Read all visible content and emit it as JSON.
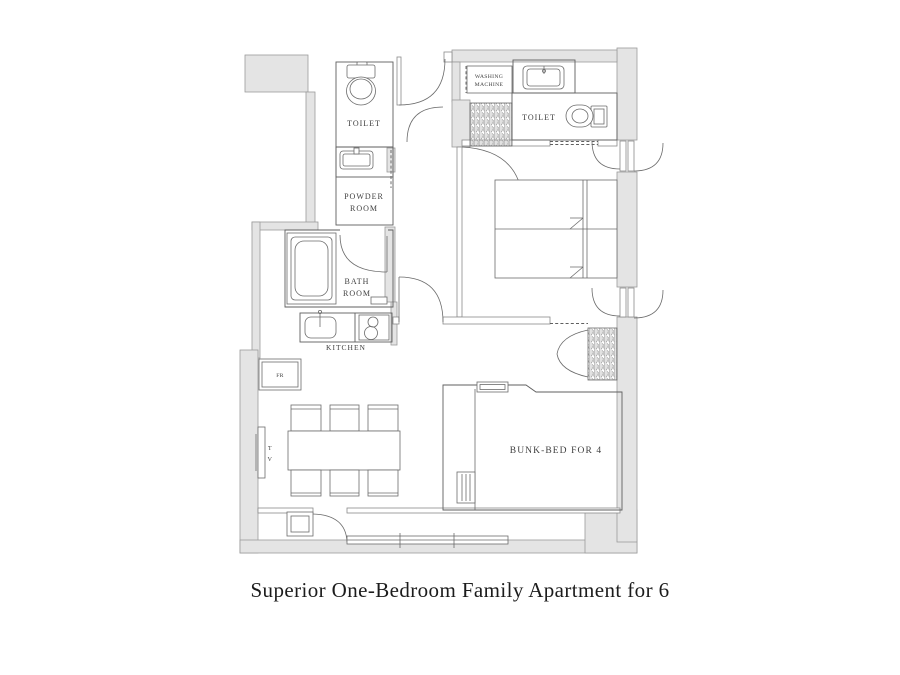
{
  "caption": "Superior One-Bedroom Family Apartment for 6",
  "labels": {
    "toilet_top_left": "TOILET",
    "powder_line1": "POWDER",
    "powder_line2": "ROOM",
    "bath_line1": "BATH",
    "bath_line2": "ROOM",
    "kitchen": "KITCHEN",
    "washing_line1": "WASHING",
    "washing_line2": "MACHINE",
    "toilet_top_right": "TOILET",
    "fridge": "FR",
    "tv_line1": "T",
    "tv_line2": "V",
    "bunk_bed": "BUNK-BED FOR 4"
  },
  "colors": {
    "wall_fill": "#e4e4e4",
    "wall_stroke": "#9b9b9b",
    "line": "#5f5f5f",
    "label_text": "#3f3f3f",
    "caption_text": "#1c1c1c",
    "background": "#ffffff"
  }
}
